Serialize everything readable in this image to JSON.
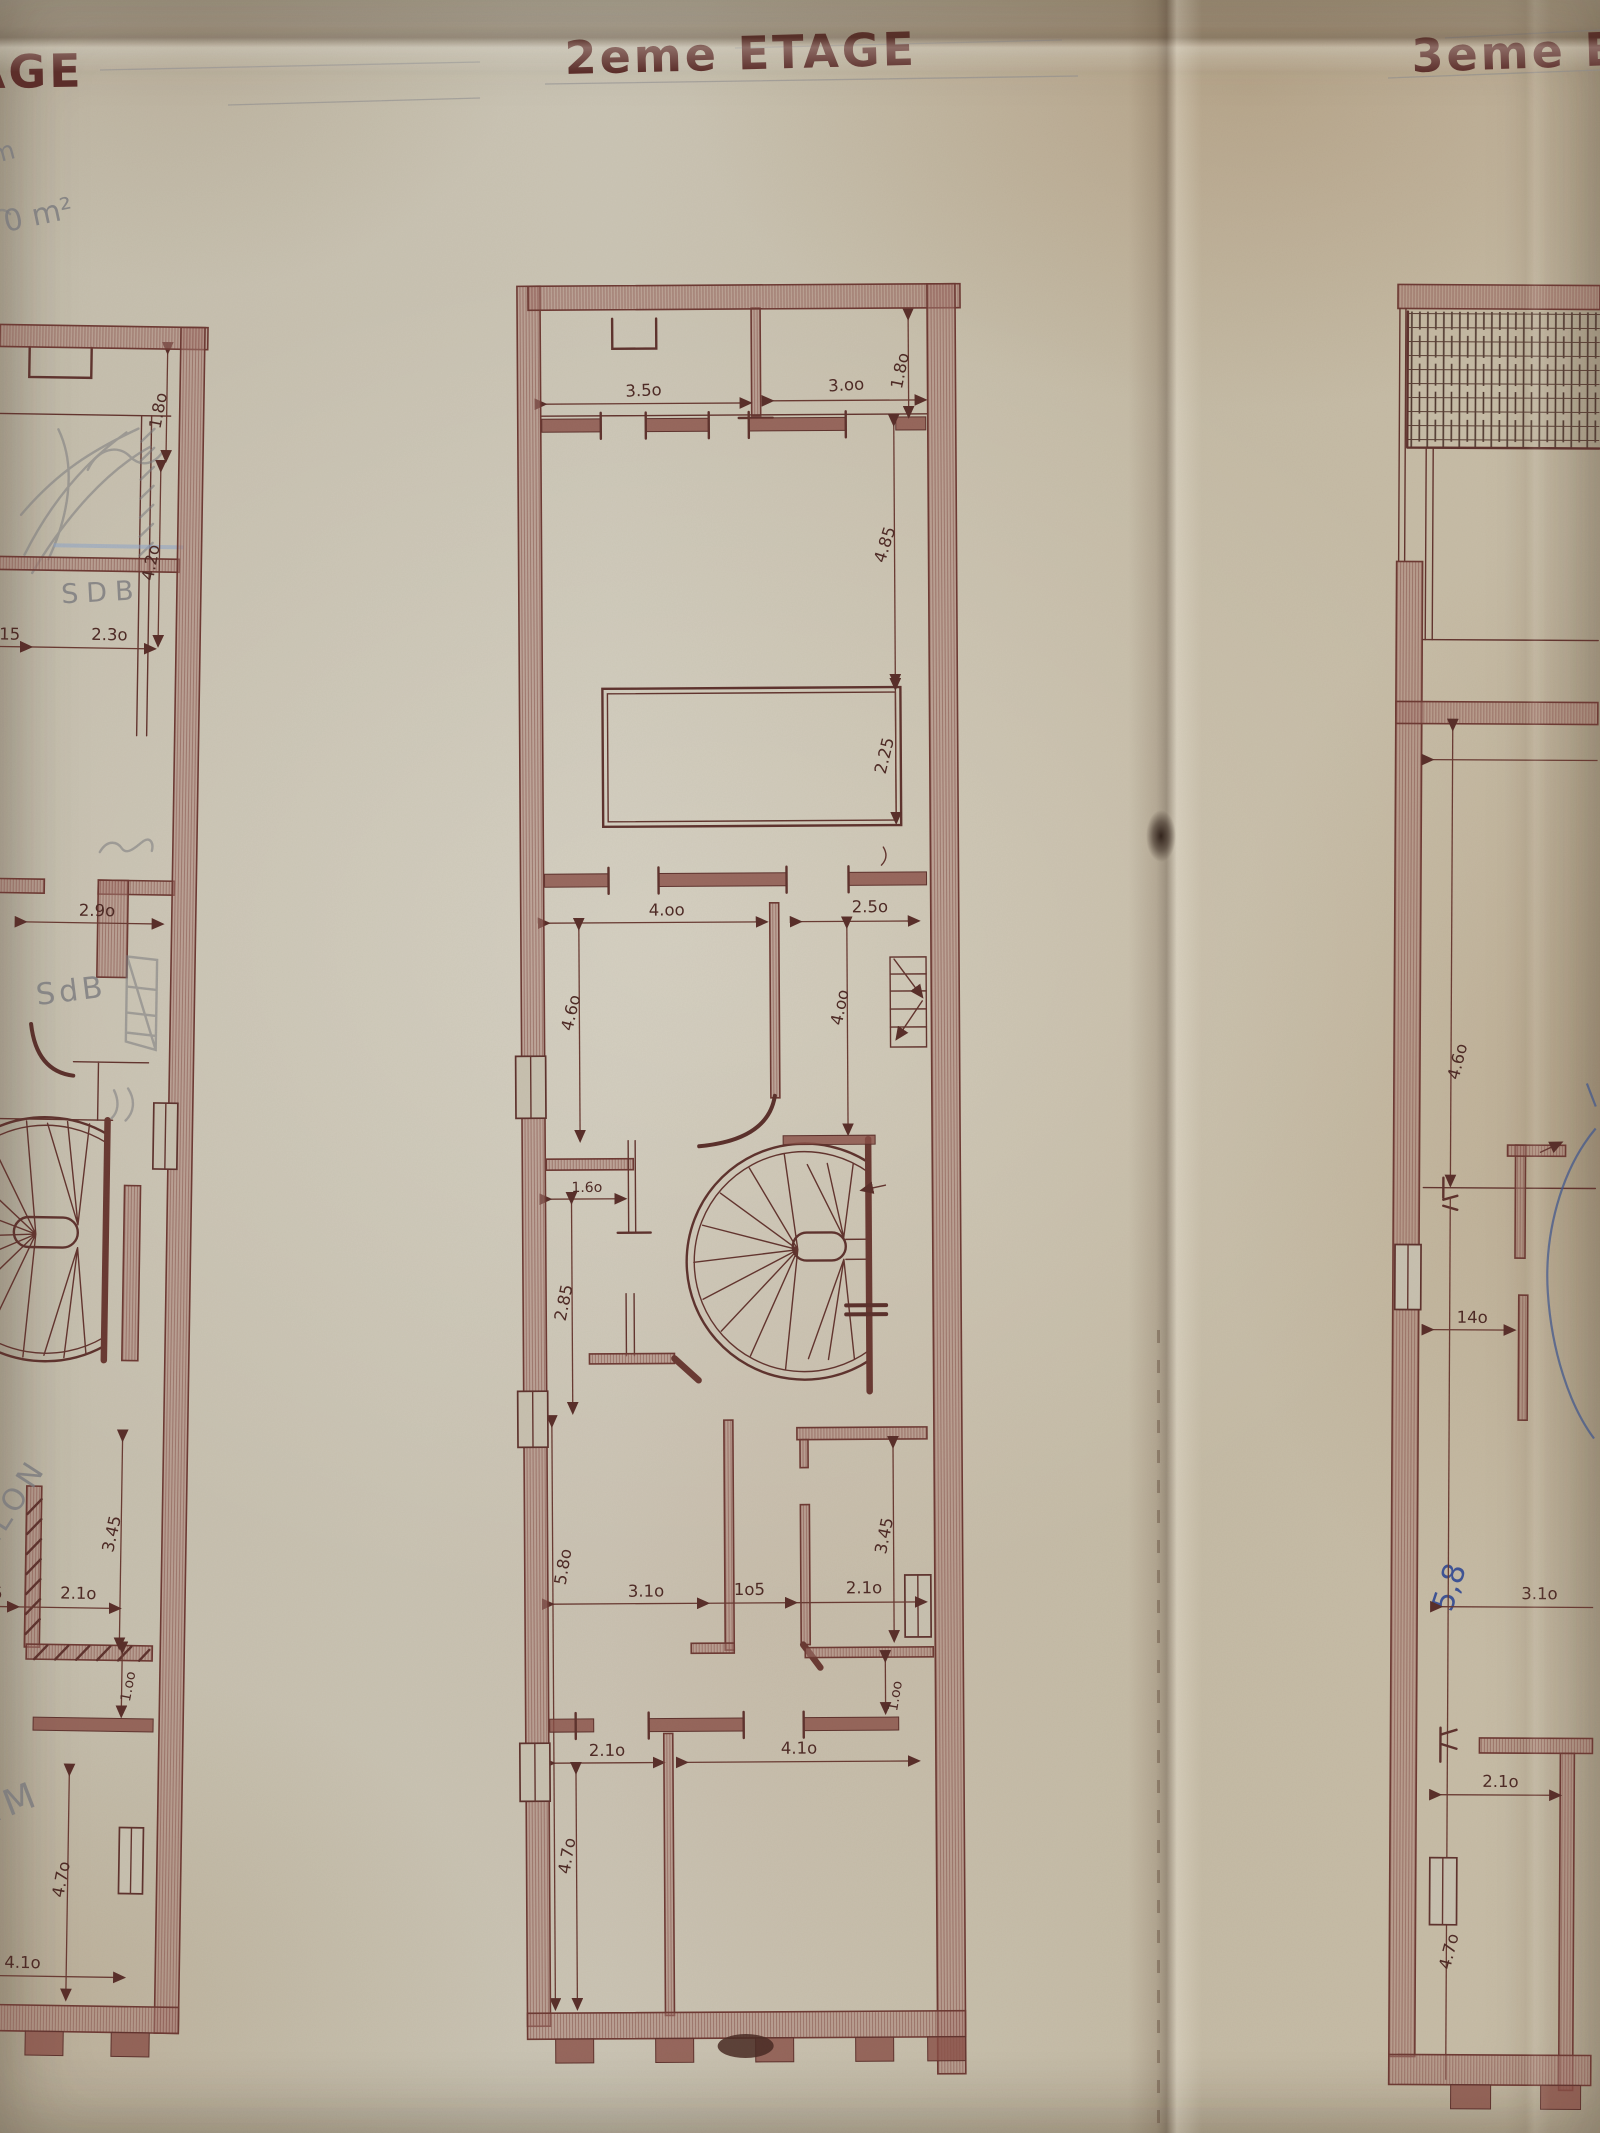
{
  "titles": {
    "left_partial": "AGE",
    "center": "2eme ETAGE",
    "right_partial": "3eme E"
  },
  "pencil_notes": {
    "top_left_line1": "m",
    "top_left_line2": "0 m²",
    "sdb_upper": "SDB",
    "sdb_lower": "SdB",
    "salon": "SALON",
    "sam_partial": "AM",
    "blue_area_note": "5,8"
  },
  "dims": {
    "left": {
      "d180": "1.8o",
      "d420": "4.2o",
      "d15": "15",
      "d230": "2.3o",
      "d290": "2.9o",
      "d345": "3.45",
      "d105p": "o5",
      "d210": "2.1o",
      "d100": "1.oo",
      "d470": "4.7o",
      "d410": "4.1o"
    },
    "center": {
      "d350": "3.5o",
      "d300": "3.oo",
      "d180": "1.8o",
      "d485": "4.85",
      "d225": "2.25",
      "d400a": "4.oo",
      "d250": "2.5o",
      "d460": "4.6o",
      "d400b": "4.oo",
      "d160": "1.6o",
      "d285": "2.85",
      "d580": "5.8o",
      "d310": "3.1o",
      "d105": "1o5",
      "d210a": "2.1o",
      "d345": "3.45",
      "d100": "1.oo",
      "d210b": "2.1o",
      "d410": "4.1o",
      "d470": "4.7o"
    },
    "right": {
      "d460": "4.6o",
      "d140": "14o",
      "d310": "3.1o",
      "d210": "2.1o",
      "d475": "4.7o"
    }
  },
  "colors": {
    "paper": "#c8c1b0",
    "ink": "#63352f",
    "wall_fill": "#a3786e",
    "pencil": "#7c7c80",
    "blue_pen": "#3f5496",
    "blue_pencil": "#8fa6c9"
  }
}
